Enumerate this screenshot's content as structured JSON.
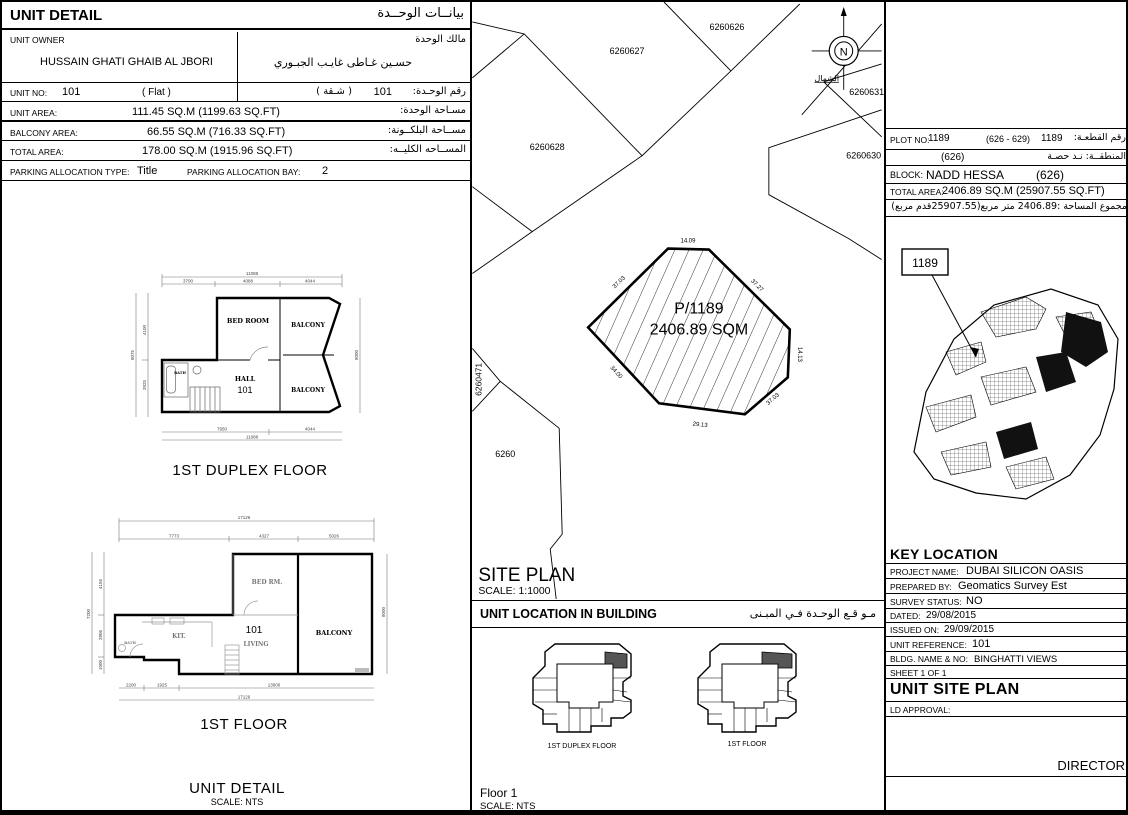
{
  "unit_detail": {
    "title_en": "UNIT DETAIL",
    "title_ar": "بيانــات الوحــدة",
    "owner": {
      "label_en": "UNIT OWNER",
      "label_ar": "مالك الوحدة",
      "name_en": "HUSSAIN GHATI GHAIB AL JBORI",
      "name_ar": "حسـين غـاطى غايـب الجبـوري"
    },
    "unit_no": {
      "label_en": "UNIT NO:",
      "value": "101",
      "type_en": "(  Flat  )",
      "label_ar": "رقم الوحـدة:",
      "value_ar": "101",
      "type_ar": "(  شـقة  )"
    },
    "areas": [
      {
        "label_en": "UNIT AREA:",
        "value": "111.45 SQ.M (1199.63 SQ.FT)",
        "label_ar": "مسـاحة الوحدة:"
      },
      {
        "label_en": "BALCONY AREA:",
        "value": "66.55 SQ.M (716.33 SQ.FT)",
        "label_ar": "مســاحة البلكــونة:"
      },
      {
        "label_en": "TOTAL AREA:",
        "value": "178.00  SQ.M (1915.96 SQ.FT)",
        "label_ar": "المســاحه الكليــه:"
      }
    ],
    "parking": {
      "type_label": "PARKING ALLOCATION TYPE:",
      "type_value": "Title",
      "bay_label": "PARKING ALLOCATION BAY:",
      "bay_value": "2"
    },
    "footer_title": "UNIT DETAIL",
    "footer_scale": "SCALE: NTS"
  },
  "duplex_plan": {
    "caption": "1ST DUPLEX FLOOR",
    "rooms": {
      "bedroom": "BED  ROOM",
      "balcony_top": "BALCONY",
      "balcony_bottom": "BALCONY",
      "hall": "HALL",
      "unit": "101",
      "bath": "BATH"
    },
    "dims": {
      "top_total": "11088",
      "top_parts": [
        "3700",
        "4088",
        "4044"
      ],
      "left_total": "8075",
      "left_parts": [
        "4100",
        "3925"
      ],
      "right": "8000",
      "bottom_parts": [
        "7950",
        "4044"
      ],
      "bottom_total": "11088"
    }
  },
  "first_floor_plan": {
    "caption": "1ST FLOOR",
    "rooms": {
      "bedroom": "BED  RM.",
      "balcony": "BALCONY",
      "unit": "101",
      "living": "LIVING",
      "kitchen": "KIT.",
      "bath": "BATH"
    },
    "dims": {
      "top_total": "17126",
      "top_parts": [
        "7773",
        "4327",
        "5026"
      ],
      "left_total": "7200",
      "left_parts": [
        "4156",
        "2806",
        "1000"
      ],
      "right": "8000",
      "bottom_parts": [
        "2200",
        "1925",
        "13000"
      ],
      "bottom_total": "17126"
    }
  },
  "site_plan": {
    "title": "SITE PLAN",
    "scale": "SCALE: 1:1000",
    "parcels": {
      "p626": "6260626",
      "p627": "6260627",
      "p628": "6260628",
      "p630": "6260630",
      "p631": "6260631",
      "p471": "6260471",
      "p6260": "6260"
    },
    "plot": {
      "name": "P/1189",
      "area": "2406.89 SQM",
      "edge_top": "14.09",
      "edge_top_left": "37.03",
      "edge_top_right": "37.27",
      "edge_right": "14.13",
      "edge_bottom_right": "37.03",
      "edge_bottom": "29.13",
      "edge_bottom_left": "34.00"
    },
    "north": {
      "letter": "N",
      "label_ar": "الشمال"
    }
  },
  "unit_location": {
    "title_en": "UNIT LOCATION IN BUILDING",
    "title_ar": "مـو قـع الوحـدة  فـي المبـنى",
    "captions": [
      "1ST DUPLEX FLOOR",
      "1ST FLOOR"
    ],
    "floor": "Floor 1",
    "scale": "SCALE:  NTS"
  },
  "plot_info": {
    "plot_no_label": "PLOT NO:",
    "plot_no": "1189",
    "plot_range": "(626 - 629)",
    "plot_no2": "1189",
    "plot_no_label_ar": "رقم القطعـة:",
    "district_label_ar": "المنطقــة: نـد حصـة",
    "district_no": "(626)",
    "block_label": "BLOCK:",
    "block_name": "NADD HESSA",
    "block_no": "(626)",
    "total_area_label": "TOTAL AREA:",
    "total_area_value": "2406.89 SQ.M (25907.55 SQ.FT)",
    "total_area_ar": "مجموع المساحة :2406.89 متر مربع(25907.55قدم مربع)"
  },
  "key_location": {
    "title": "KEY LOCATION",
    "map_plot_label": "1189",
    "rows": [
      {
        "label": "PROJECT NAME:",
        "value": "DUBAI SILICON  OASIS"
      },
      {
        "label": "PREPARED BY:",
        "value": "Geomatics Survey Est"
      },
      {
        "label": "SURVEY STATUS:",
        "value": "NO"
      },
      {
        "label": "DATED:",
        "value": "29/08/2015"
      },
      {
        "label": "ISSUED ON:",
        "value": "29/09/2015"
      },
      {
        "label": "UNIT REFERENCE:",
        "value": "101"
      },
      {
        "label": "BLDG. NAME & NO:",
        "value": "BINGHATTI VIEWS"
      },
      {
        "label": "SHEET 1 OF 1",
        "value": ""
      }
    ],
    "doc_type": "UNIT SITE PLAN",
    "ld_approval": "LD APPROVAL:",
    "director": "DIRECTOR"
  }
}
